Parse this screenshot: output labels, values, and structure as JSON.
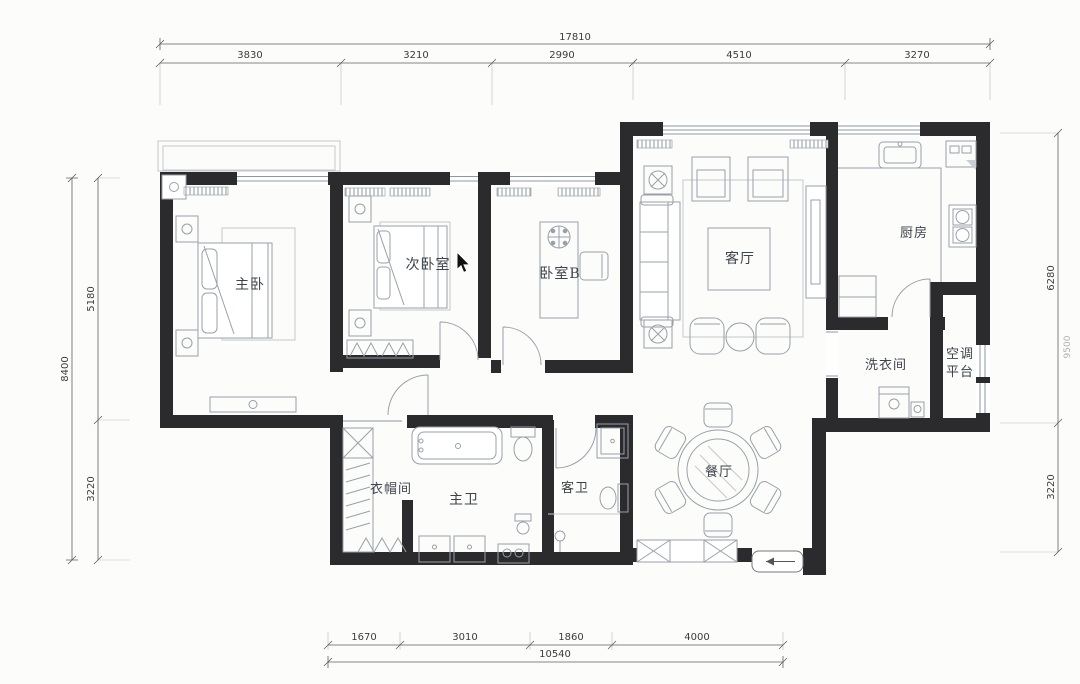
{
  "floor_plan": {
    "title": "residential apartment floor plan",
    "rooms": {
      "master_bedroom": "主卧",
      "second_bedroom": "次卧室",
      "bedroom_b": "卧室B",
      "living_room": "客厅",
      "kitchen": "厨房",
      "laundry_room": "洗衣间",
      "ac_platform_line1": "空调",
      "ac_platform_line2": "平台",
      "dining_room": "餐厅",
      "cloakroom": "衣帽间",
      "master_bathroom": "主卫",
      "guest_bathroom": "客卫"
    },
    "dimensions": {
      "top_total": "17810",
      "top_segments": [
        "3830",
        "3210",
        "2990",
        "4510",
        "3270"
      ],
      "left_total": "8400",
      "left_segments": [
        "5180",
        "3220"
      ],
      "right_total": "9500",
      "right_segments": [
        "6280",
        "3220"
      ],
      "bottom_total": "10540",
      "bottom_segments": [
        "1670",
        "3010",
        "1860",
        "4000"
      ]
    },
    "colors": {
      "wall": "#2b2b2e",
      "furniture_line": "#98a1a9",
      "dimension_line": "#5f5f5f",
      "paper": "#fcfcfa",
      "label_text": "#3d434a"
    }
  },
  "cursor": {
    "x": 457,
    "y": 252
  }
}
